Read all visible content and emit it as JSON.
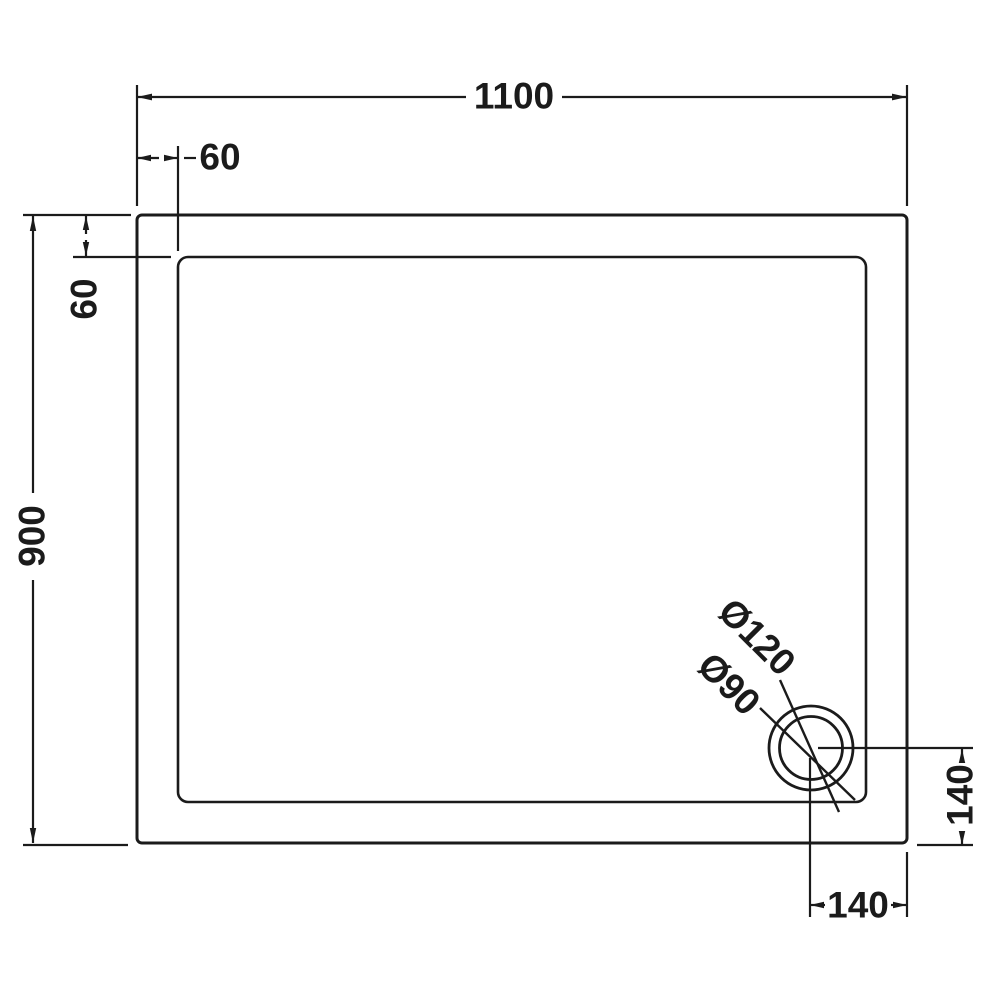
{
  "drawing": {
    "type": "technical-dimension-drawing",
    "subject": "rectangular-shower-tray-plan-view",
    "line_color": "#1b1b1b",
    "background_color": "#ffffff",
    "labels": {
      "overall_width": "1100",
      "overall_height": "900",
      "rim_offset_top": "60",
      "rim_offset_left": "60",
      "drain_outer_diameter": "Ø120",
      "drain_inner_diameter": "Ø90",
      "drain_offset_from_right": "140",
      "drain_offset_from_bottom": "140"
    }
  }
}
